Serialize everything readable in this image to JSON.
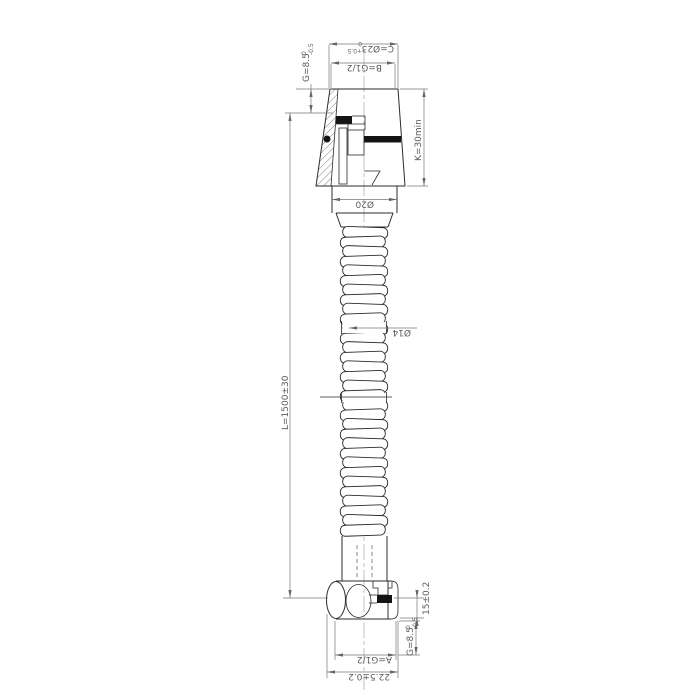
{
  "drawing": {
    "type": "technical-drawing",
    "subject": "shower-hose-cross-section",
    "dimensions": {
      "c": {
        "label": "C=Ø23",
        "tol_upper": "+0.5",
        "tol_lower": "0"
      },
      "b": {
        "label": "B=G1/2"
      },
      "g_top": {
        "label": "G=8.5",
        "tol_upper": "0",
        "tol_lower": "-0.5"
      },
      "k": {
        "label": "K=30min"
      },
      "phi20": {
        "label": "Ø20"
      },
      "phi14": {
        "label": "Ø14"
      },
      "length": {
        "label": "L=1500±30"
      },
      "dim_15": {
        "label": "15±0.2"
      },
      "g_bottom": {
        "label": "G=8.5",
        "tol_upper": "0",
        "tol_lower": "-0.5"
      },
      "a": {
        "label": "A=G1/2"
      },
      "dim_225": {
        "label": "22.5±0.2"
      }
    },
    "colors": {
      "background": "#ffffff",
      "outline": "#2b2b2b",
      "dimension": "#777777",
      "seal_fill": "#141414"
    }
  }
}
